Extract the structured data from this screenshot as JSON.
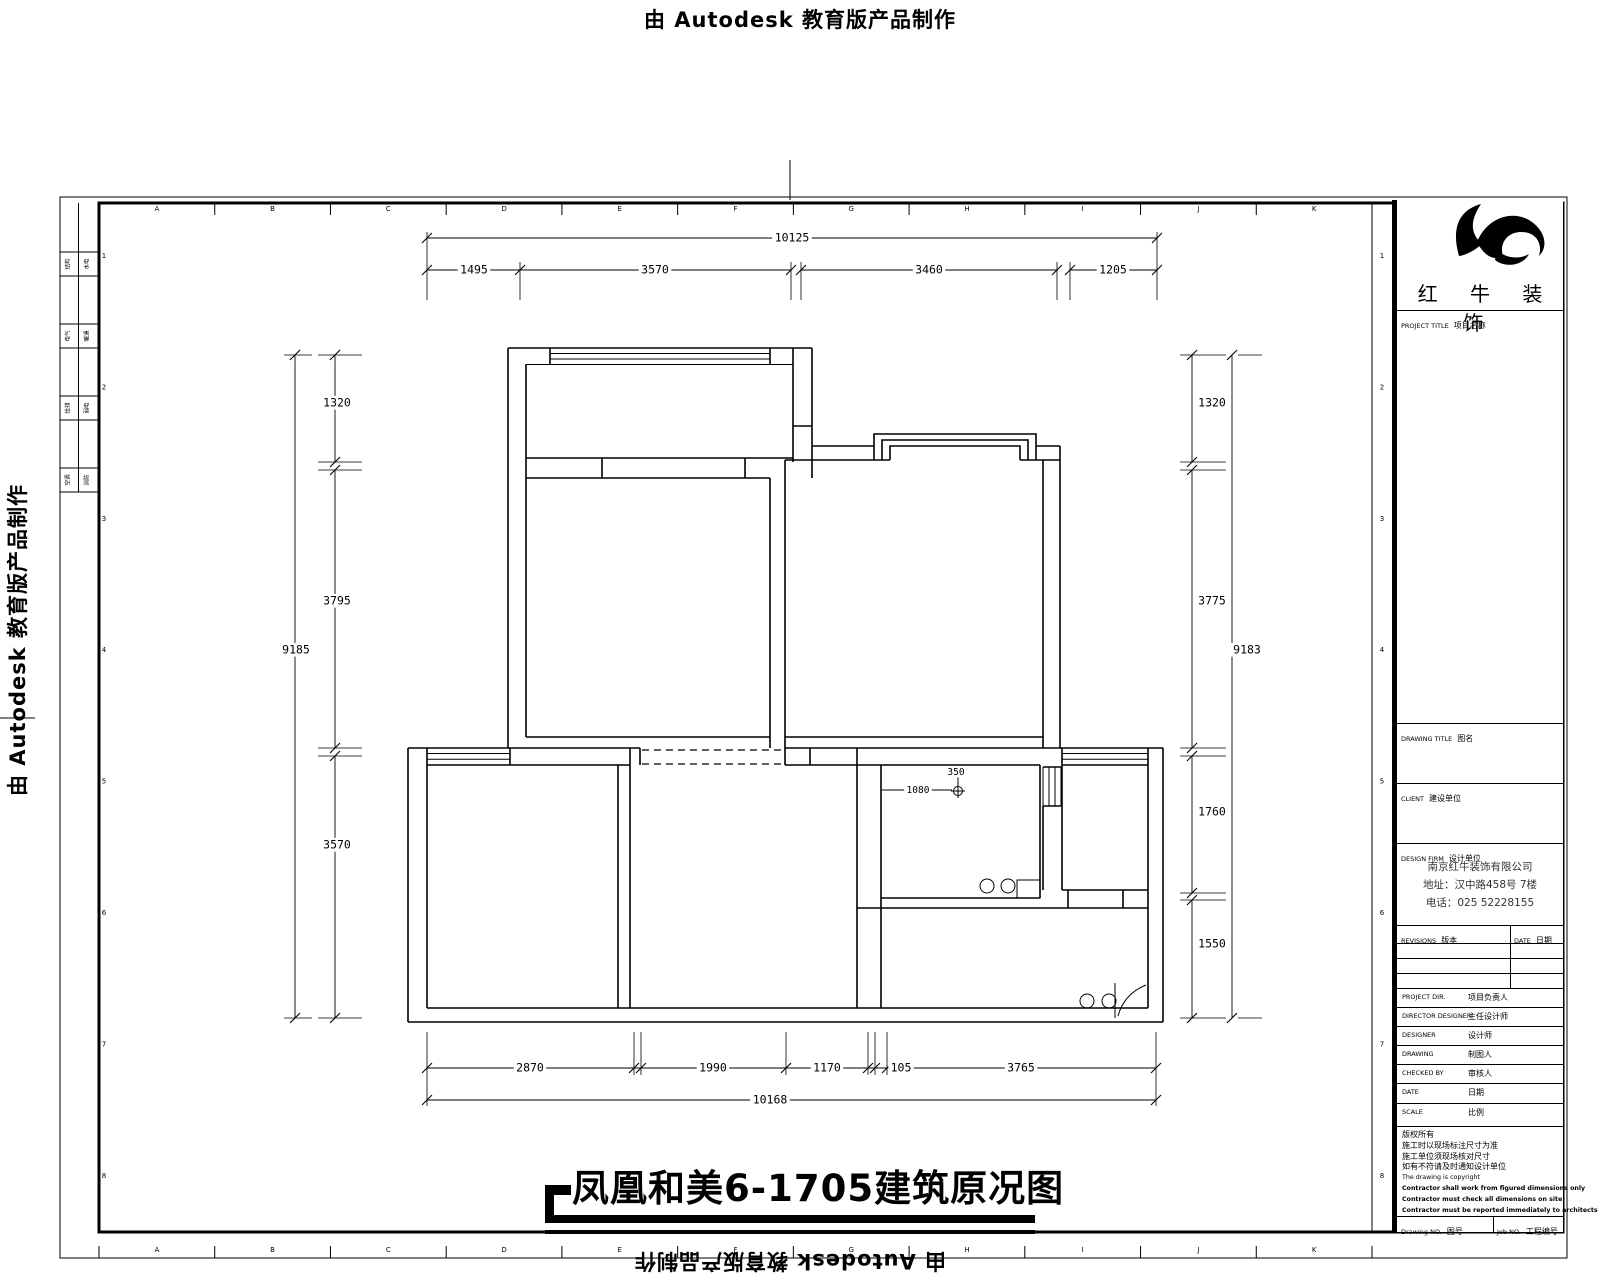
{
  "stamp": {
    "text": "由 Autodesk 教育版产品制作"
  },
  "sheet": {
    "grid_letters": [
      "A",
      "B",
      "C",
      "D",
      "E",
      "F",
      "G",
      "H",
      "I",
      "J",
      "K"
    ],
    "row_numbers": [
      "1",
      "2",
      "3",
      "4",
      "5",
      "6",
      "7",
      "8"
    ],
    "legend_cells": [
      [
        "结构",
        "水电"
      ],
      [
        "电气",
        "暖通"
      ],
      [
        "给排",
        "弱电"
      ],
      [
        "空调",
        "消防"
      ]
    ]
  },
  "plan": {
    "title": "凤凰和美6-1705建筑原况图",
    "dims": {
      "top": {
        "overall": "10125",
        "segments": [
          "1495",
          "3570",
          "3460",
          "1205"
        ]
      },
      "bottom": {
        "overall": "10168",
        "segments": [
          "2870",
          "1990",
          "1170",
          "105",
          "3765"
        ]
      },
      "left": {
        "overall": "9185",
        "segments": [
          "1320",
          "3795",
          "3570"
        ]
      },
      "right": {
        "overall": "9183",
        "segments": [
          "1320",
          "3775",
          "1760",
          "1550"
        ]
      },
      "interior": {
        "offset": "1080",
        "point": "350"
      }
    }
  },
  "title_block": {
    "logo": "红 牛 装 饰",
    "project_title": {
      "en": "PROJECT TITLE",
      "cn": "项目名称"
    },
    "drawing_title": {
      "en": "DRAWING TITLE",
      "cn": "图名"
    },
    "client": {
      "en": "CLIENT",
      "cn": "建设单位"
    },
    "design_firm": {
      "en": "DESIGN FIRM",
      "cn": "设计单位"
    },
    "company": [
      "南京红牛装饰有限公司",
      "地址：汉中路458号 7楼",
      "电话：025 52228155"
    ],
    "revisions": {
      "en": "REVISIONS",
      "cn": "版本"
    },
    "rev_date": {
      "en": "DATE",
      "cn": "日期"
    },
    "people": [
      {
        "en": "PROJECT DIR.",
        "cn": "项目负责人"
      },
      {
        "en": "DIRECTOR DESIGNER",
        "cn": "主任设计师"
      },
      {
        "en": "DESIGNER",
        "cn": "设计师"
      },
      {
        "en": "DRAWING",
        "cn": "制图人"
      },
      {
        "en": "CHECKED BY",
        "cn": "审核人"
      },
      {
        "en": "DATE",
        "cn": "日期"
      },
      {
        "en": "SCALE",
        "cn": "比例"
      }
    ],
    "notes": [
      "版权所有",
      "施工时以现场标注尺寸为准",
      "施工单位须现场核对尺寸",
      "如有不符请及时通知设计单位",
      "The drawing is copyright"
    ],
    "notes_bold": [
      "Contractor shall work from figured dimensions only",
      "Contractor must check all dimensions on site",
      "Contractor must be reported immediately to architects"
    ],
    "drawing_no": {
      "en": "Drawing NO.",
      "cn": "图号"
    },
    "job_no": {
      "en": "Job NO.",
      "cn": "工程编号"
    }
  }
}
